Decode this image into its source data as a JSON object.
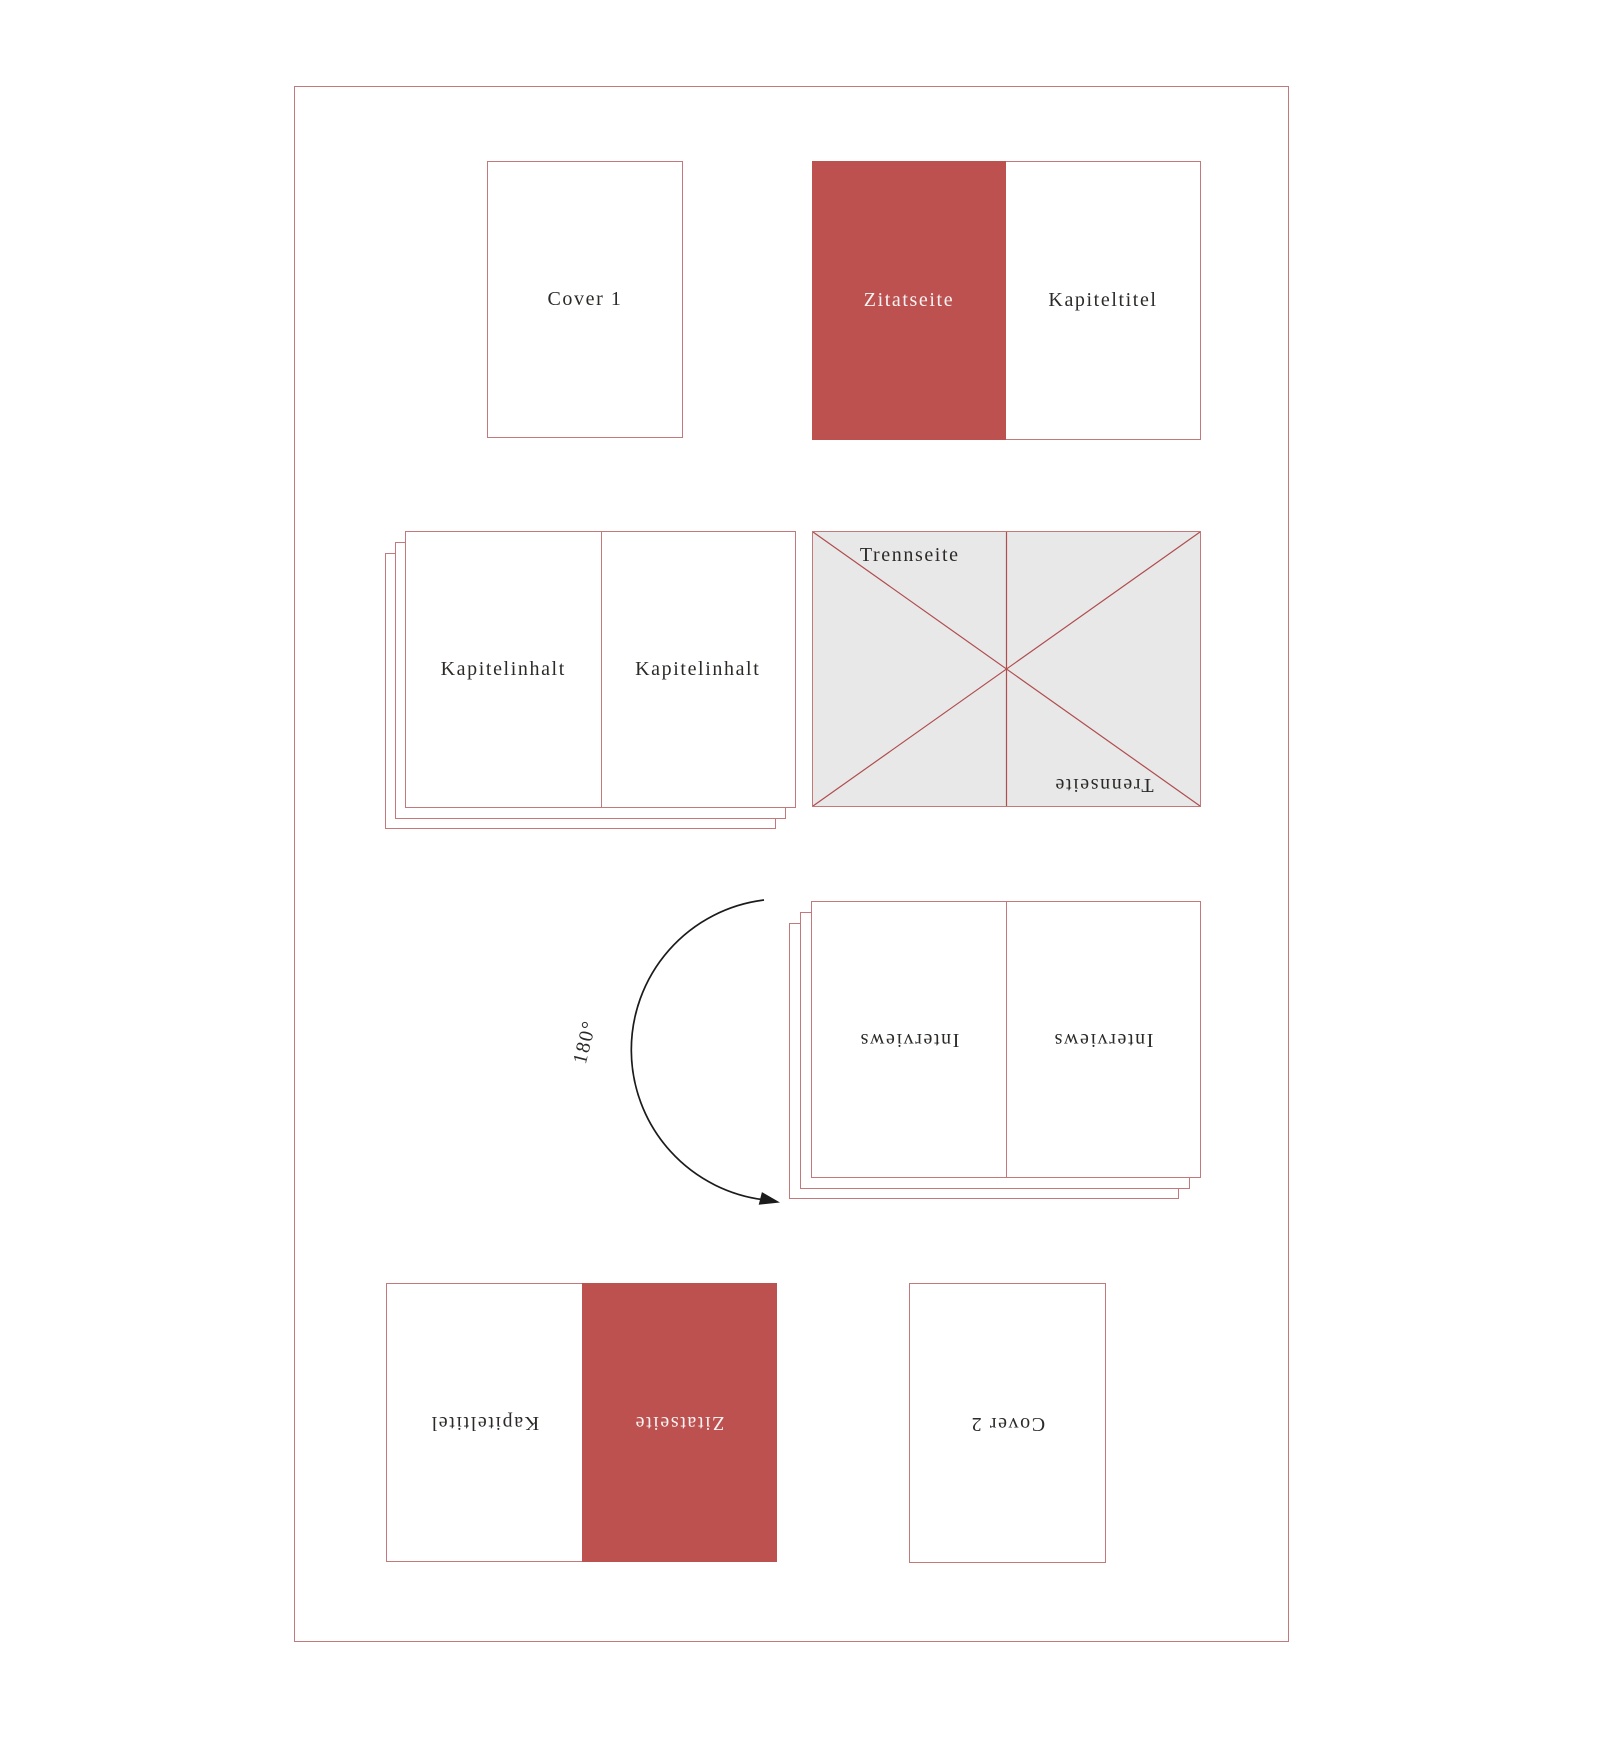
{
  "page": {
    "background": "#ffffff"
  },
  "colors": {
    "accent_red": "#bc5150",
    "line_red": "#c3797b",
    "diagonal_red": "#b04d4f",
    "page_gray": "#e9e8e8",
    "text_dark": "#2b2a28",
    "text_light": "#f8f3f2"
  },
  "icons": {
    "trennseite_cross": "diagonal-cross-with-center-line",
    "rotation_arrow": "semicircular-arc-arrow-left"
  },
  "items": {
    "cover1": {
      "label": "Cover 1"
    },
    "spread_quote_top": {
      "left_label": "Zitatseite",
      "right_label": "Kapiteltitel"
    },
    "stack_chapter": {
      "left_label": "Kapitelinhalt",
      "right_label": "Kapitelinhalt"
    },
    "spread_divider": {
      "top_label": "Trennseite",
      "bottom_label": "Trennseite"
    },
    "rotation": {
      "label": "180°"
    },
    "stack_interviews": {
      "left_label": "Interviews",
      "right_label": "Interviews"
    },
    "spread_quote_bottom": {
      "left_label": "Kapiteltitel",
      "right_label": "Zitatseite"
    },
    "cover2": {
      "label": "Cover 2"
    }
  }
}
